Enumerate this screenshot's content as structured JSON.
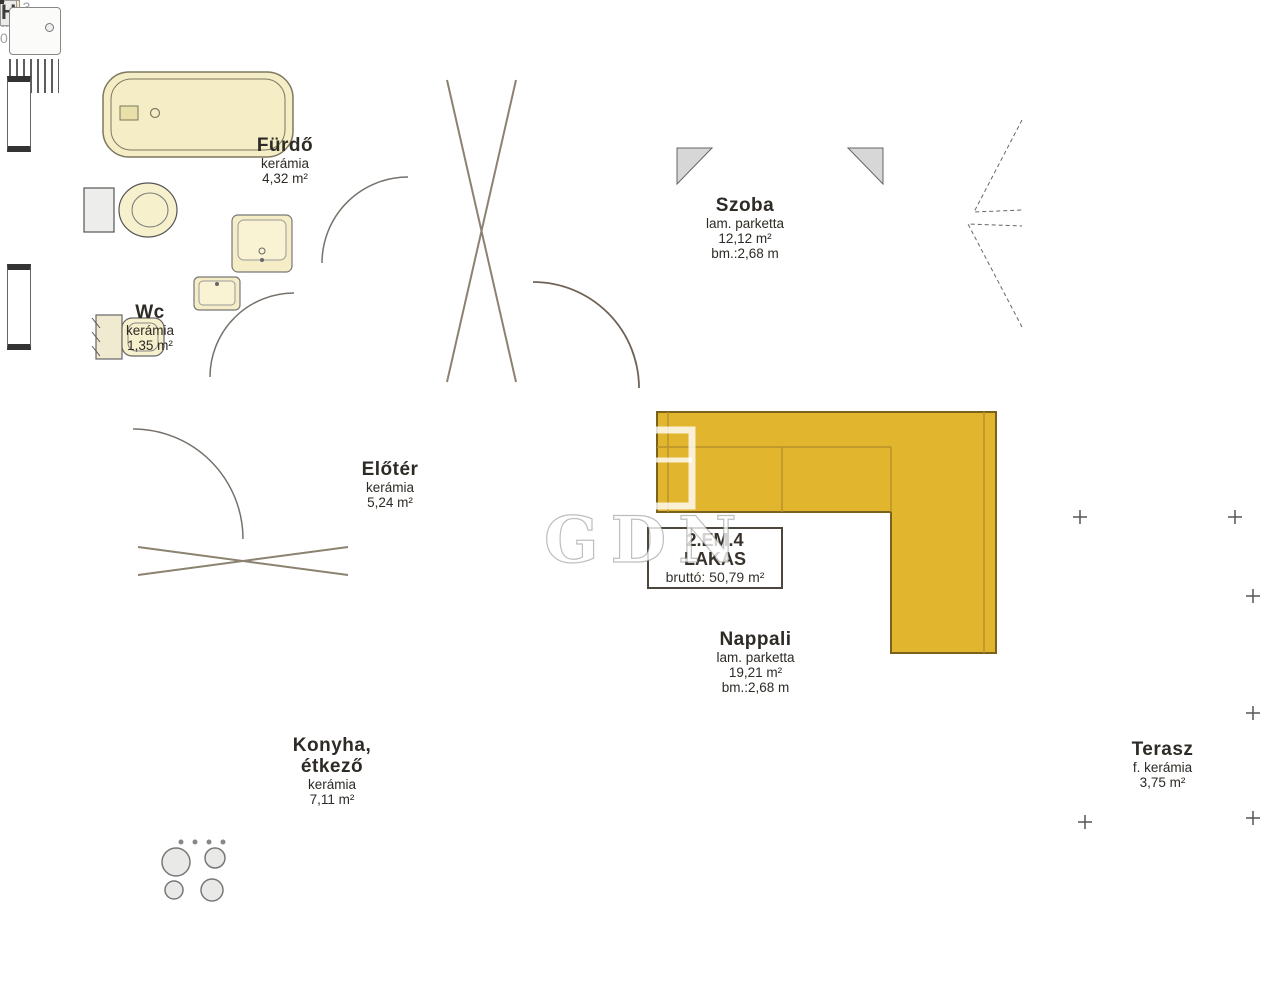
{
  "plan": {
    "watermark": "GDN",
    "unit_label": {
      "floor_line": "2.EM.4",
      "type_line": "LAKAS",
      "gross_area": "bruttó: 50,79 m²"
    },
    "rooms": {
      "furdo": {
        "name": "Fürdő",
        "material": "kerámia",
        "area": "4,32 m²"
      },
      "wc": {
        "name": "Wc",
        "material": "kerámia",
        "area": "1,35 m²"
      },
      "szoba": {
        "name": "Szoba",
        "material": "lam. parketta",
        "area": "12,12 m²",
        "ceiling": "bm.:2,68 m"
      },
      "eloter": {
        "name": "Előtér",
        "material": "kerámia",
        "area": "5,24 m²"
      },
      "konyha": {
        "name_line1": "Konyha,",
        "name_line2": "étkező",
        "material": "kerámia",
        "area": "7,11 m²"
      },
      "nappali": {
        "name": "Nappali",
        "material": "lam. parketta",
        "area": "19,21 m²",
        "ceiling": "bm.:2,68 m"
      },
      "terasz": {
        "name": "Terasz",
        "material": "f. kerámia",
        "area": "3,75 m²"
      }
    },
    "appliances": {
      "washing_machine": "M",
      "fridge": "H"
    },
    "neighbor_text": {
      "line1": "ló 13.",
      "line2": "ámia",
      "line3": "0 m²"
    },
    "colors": {
      "wood_floor": "#c09a72",
      "kitchen_tile": "#8d8164",
      "bath_tile": "#e4e4e7",
      "terrace_tile": "#ededef",
      "sofa_yellow": "#e2b52e",
      "furniture_cream": "#f2ebc6",
      "washer_letter_red": "#c43b3b",
      "outside_gray": "#c9c9c9"
    }
  }
}
